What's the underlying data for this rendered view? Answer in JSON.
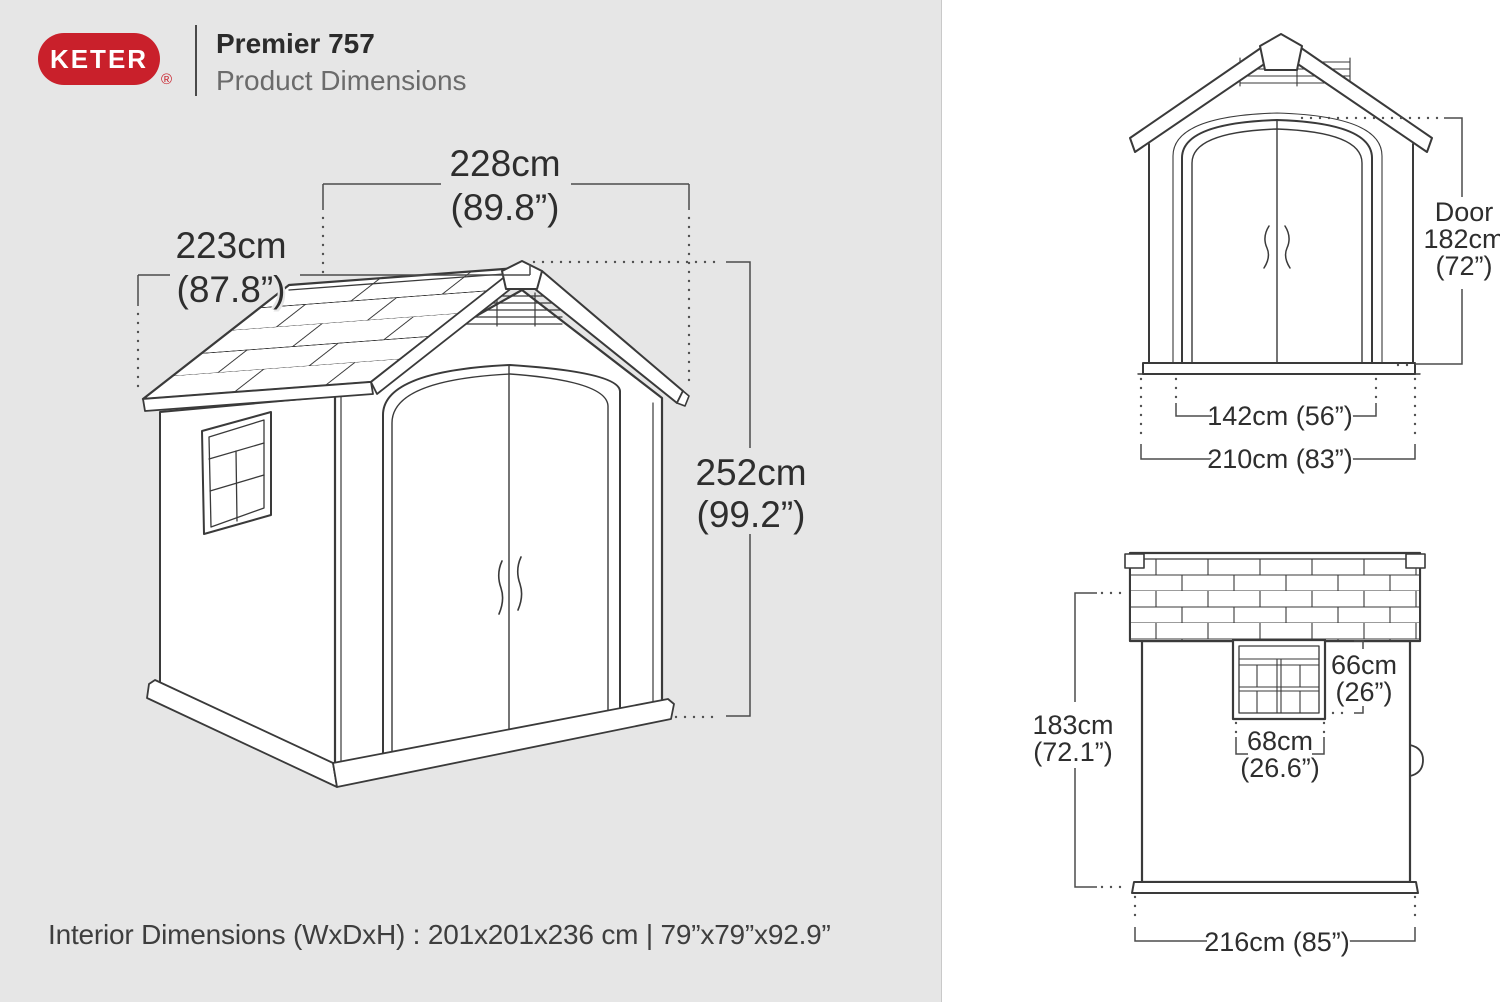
{
  "header": {
    "brand": "KETER",
    "registered": "®",
    "title": "Premier 757",
    "subtitle": "Product Dimensions"
  },
  "iso": {
    "depth_cm": "228cm",
    "depth_in": "(89.8”)",
    "width_cm": "223cm",
    "width_in": "(87.8”)",
    "height_cm": "252cm",
    "height_in": "(99.2”)"
  },
  "front": {
    "door_label": "Door",
    "door_cm": "182cm",
    "door_in": "(72”)",
    "door_width": "142cm (56”)",
    "overall_width": "210cm (83”)"
  },
  "side": {
    "height_cm": "183cm",
    "height_in": "(72.1”)",
    "window_h_cm": "66cm",
    "window_h_in": "(26”)",
    "window_w_cm": "68cm",
    "window_w_in": "(26.6”)",
    "depth": "216cm (85”)"
  },
  "footer": {
    "interior": "Interior Dimensions (WxDxH) : 201x201x236 cm | 79”x79”x92.9”"
  },
  "colors": {
    "brand_red": "#c9202b",
    "panel_left_bg": "#e6e6e6",
    "panel_right_bg": "#ffffff",
    "line": "#3a3a3a",
    "dim_line": "#4b4b4b",
    "text": "#2e2e2e"
  }
}
